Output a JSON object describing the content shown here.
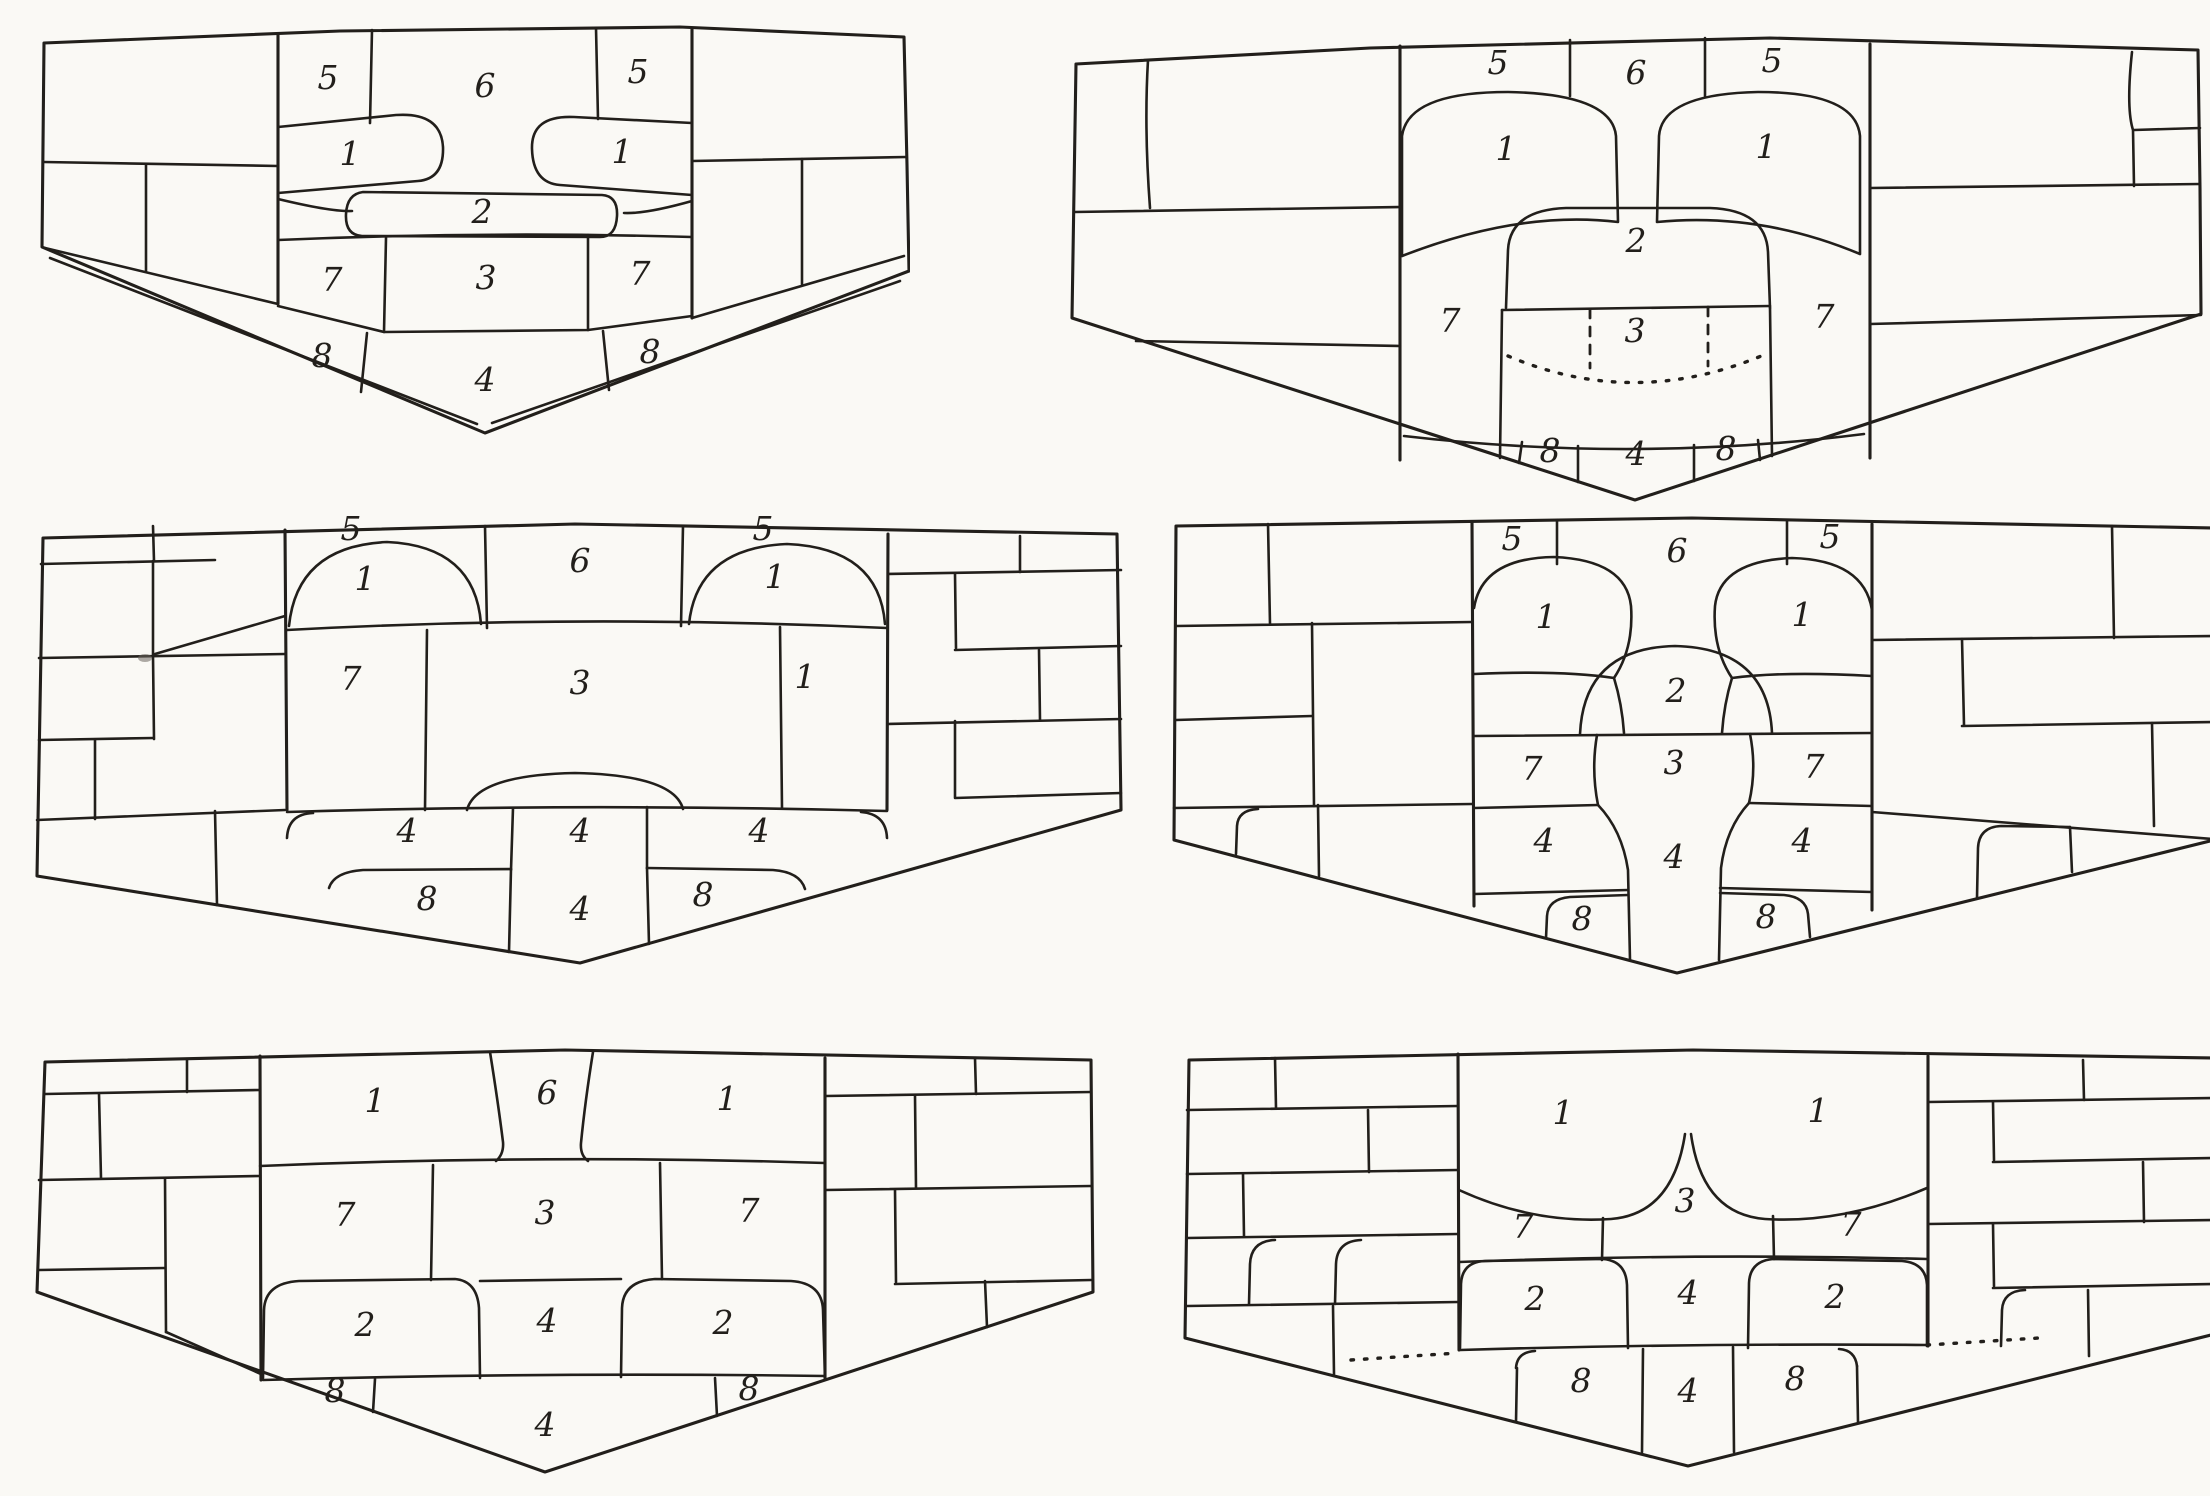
{
  "colors": {
    "paper": "#faf9f5",
    "ink": "#221f1b"
  },
  "panels": [
    {
      "name": "shield-diagram-top-left",
      "labels": [
        {
          "t": "5",
          "x": 288,
          "y": 74
        },
        {
          "t": "6",
          "x": 445,
          "y": 82
        },
        {
          "t": "5",
          "x": 598,
          "y": 68
        },
        {
          "t": "1",
          "x": 310,
          "y": 150
        },
        {
          "t": "1",
          "x": 582,
          "y": 148
        },
        {
          "t": "2",
          "x": 442,
          "y": 208
        },
        {
          "t": "7",
          "x": 292,
          "y": 276
        },
        {
          "t": "3",
          "x": 446,
          "y": 274
        },
        {
          "t": "7",
          "x": 600,
          "y": 270
        },
        {
          "t": "8",
          "x": 282,
          "y": 352
        },
        {
          "t": "4",
          "x": 445,
          "y": 376
        },
        {
          "t": "8",
          "x": 610,
          "y": 348
        }
      ]
    },
    {
      "name": "shield-diagram-top-right",
      "labels": [
        {
          "t": "5",
          "x": 428,
          "y": 66
        },
        {
          "t": "6",
          "x": 566,
          "y": 76
        },
        {
          "t": "5",
          "x": 702,
          "y": 64
        },
        {
          "t": "1",
          "x": 436,
          "y": 152
        },
        {
          "t": "1",
          "x": 696,
          "y": 150
        },
        {
          "t": "2",
          "x": 566,
          "y": 244
        },
        {
          "t": "7",
          "x": 380,
          "y": 324
        },
        {
          "t": "3",
          "x": 565,
          "y": 334
        },
        {
          "t": "7",
          "x": 754,
          "y": 320
        },
        {
          "t": "8",
          "x": 480,
          "y": 454
        },
        {
          "t": "4",
          "x": 566,
          "y": 457
        },
        {
          "t": "8",
          "x": 656,
          "y": 452
        }
      ]
    },
    {
      "name": "shield-diagram-middle-left",
      "labels": [
        {
          "t": "5",
          "x": 316,
          "y": 32
        },
        {
          "t": "6",
          "x": 545,
          "y": 64
        },
        {
          "t": "5",
          "x": 728,
          "y": 32
        },
        {
          "t": "1",
          "x": 330,
          "y": 82
        },
        {
          "t": "1",
          "x": 740,
          "y": 80
        },
        {
          "t": "7",
          "x": 316,
          "y": 182
        },
        {
          "t": "3",
          "x": 545,
          "y": 186
        },
        {
          "t": "1",
          "x": 770,
          "y": 180
        },
        {
          "t": "4",
          "x": 372,
          "y": 334
        },
        {
          "t": "4",
          "x": 545,
          "y": 334
        },
        {
          "t": "4",
          "x": 724,
          "y": 334
        },
        {
          "t": "8",
          "x": 392,
          "y": 402
        },
        {
          "t": "4",
          "x": 545,
          "y": 412
        },
        {
          "t": "8",
          "x": 668,
          "y": 398
        }
      ]
    },
    {
      "name": "shield-diagram-middle-right",
      "labels": [
        {
          "t": "5",
          "x": 340,
          "y": 42
        },
        {
          "t": "6",
          "x": 505,
          "y": 54
        },
        {
          "t": "5",
          "x": 658,
          "y": 40
        },
        {
          "t": "1",
          "x": 374,
          "y": 120
        },
        {
          "t": "1",
          "x": 630,
          "y": 118
        },
        {
          "t": "2",
          "x": 504,
          "y": 194
        },
        {
          "t": "7",
          "x": 360,
          "y": 272
        },
        {
          "t": "3",
          "x": 502,
          "y": 266
        },
        {
          "t": "7",
          "x": 642,
          "y": 270
        },
        {
          "t": "4",
          "x": 372,
          "y": 344
        },
        {
          "t": "4",
          "x": 502,
          "y": 360
        },
        {
          "t": "4",
          "x": 630,
          "y": 344
        },
        {
          "t": "8",
          "x": 410,
          "y": 422
        },
        {
          "t": "8",
          "x": 594,
          "y": 420
        }
      ]
    },
    {
      "name": "shield-diagram-bottom-left",
      "labels": [
        {
          "t": "1",
          "x": 340,
          "y": 70
        },
        {
          "t": "6",
          "x": 512,
          "y": 62
        },
        {
          "t": "1",
          "x": 692,
          "y": 68
        },
        {
          "t": "7",
          "x": 310,
          "y": 184
        },
        {
          "t": "3",
          "x": 510,
          "y": 182
        },
        {
          "t": "7",
          "x": 714,
          "y": 180
        },
        {
          "t": "2",
          "x": 330,
          "y": 294
        },
        {
          "t": "4",
          "x": 512,
          "y": 290
        },
        {
          "t": "2",
          "x": 688,
          "y": 292
        },
        {
          "t": "8",
          "x": 300,
          "y": 360
        },
        {
          "t": "4",
          "x": 510,
          "y": 394
        },
        {
          "t": "8",
          "x": 714,
          "y": 358
        }
      ]
    },
    {
      "name": "shield-diagram-bottom-right",
      "labels": [
        {
          "t": "1",
          "x": 380,
          "y": 86
        },
        {
          "t": "1",
          "x": 635,
          "y": 84
        },
        {
          "t": "7",
          "x": 340,
          "y": 200
        },
        {
          "t": "3",
          "x": 502,
          "y": 174
        },
        {
          "t": "7",
          "x": 668,
          "y": 198
        },
        {
          "t": "2",
          "x": 352,
          "y": 272
        },
        {
          "t": "4",
          "x": 505,
          "y": 266
        },
        {
          "t": "2",
          "x": 652,
          "y": 270
        },
        {
          "t": "8",
          "x": 398,
          "y": 354
        },
        {
          "t": "4",
          "x": 505,
          "y": 364
        },
        {
          "t": "8",
          "x": 612,
          "y": 352
        }
      ]
    }
  ]
}
